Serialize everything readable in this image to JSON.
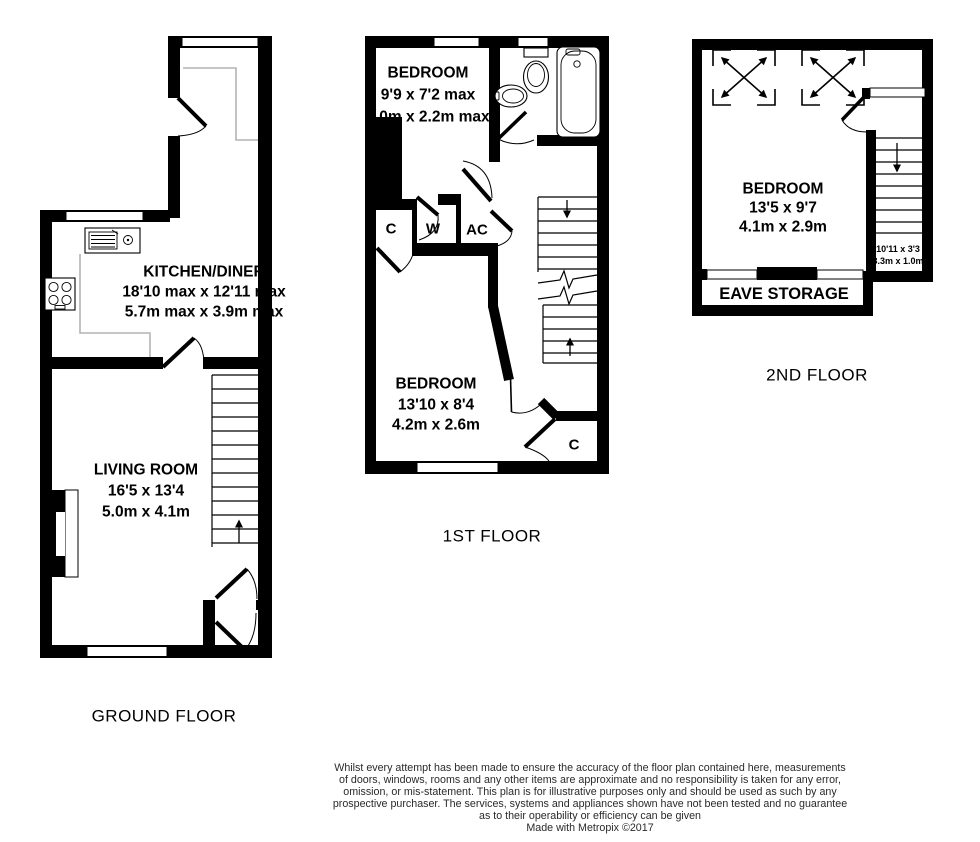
{
  "colors": {
    "wall": "#000000",
    "counter": "#b4b4b4",
    "background": "#ffffff",
    "disclaimer_text": "#2a2a2a"
  },
  "ground_floor": {
    "label": "GROUND FLOOR",
    "kitchen": {
      "name": "KITCHEN/DINER",
      "size_imperial": "18'10 max x 12'11 max",
      "size_metric": "5.7m max x 3.9m max"
    },
    "living_room": {
      "name": "LIVING ROOM",
      "size_imperial": "16'5 x 13'4",
      "size_metric": "5.0m x 4.1m"
    }
  },
  "first_floor": {
    "label": "1ST FLOOR",
    "bedroom_front": {
      "name": "BEDROOM",
      "size_imperial": "9'9 x 7'2 max",
      "size_metric": "3.0m x 2.2m max"
    },
    "bedroom_back": {
      "name": "BEDROOM",
      "size_imperial": "13'10 x 8'4",
      "size_metric": "4.2m x 2.6m"
    },
    "cupboard_left": "C",
    "wardrobe": "W",
    "airing_cupboard": "AC",
    "cupboard_right": "C"
  },
  "second_floor": {
    "label": "2ND FLOOR",
    "bedroom": {
      "name": "BEDROOM",
      "size_imperial": "13'5 x 9'7",
      "size_metric": "4.1m x 2.9m"
    },
    "eave_storage": {
      "name": "EAVE STORAGE"
    },
    "stair_area": {
      "size_imperial": "10'11 x 3'3",
      "size_metric": "3.3m x 1.0m"
    }
  },
  "footer": {
    "disclaimer_lines": [
      "Whilst every attempt has been made to ensure the accuracy of the floor plan contained here, measurements",
      "of doors, windows, rooms and any other items are approximate and no responsibility is taken for any error,",
      "omission, or mis-statement. This plan is for illustrative purposes only and should be used as such by any",
      "prospective purchaser. The services, systems and appliances shown have not been tested and no guarantee",
      "as to their operability or efficiency can be given",
      "Made with Metropix ©2017"
    ]
  }
}
